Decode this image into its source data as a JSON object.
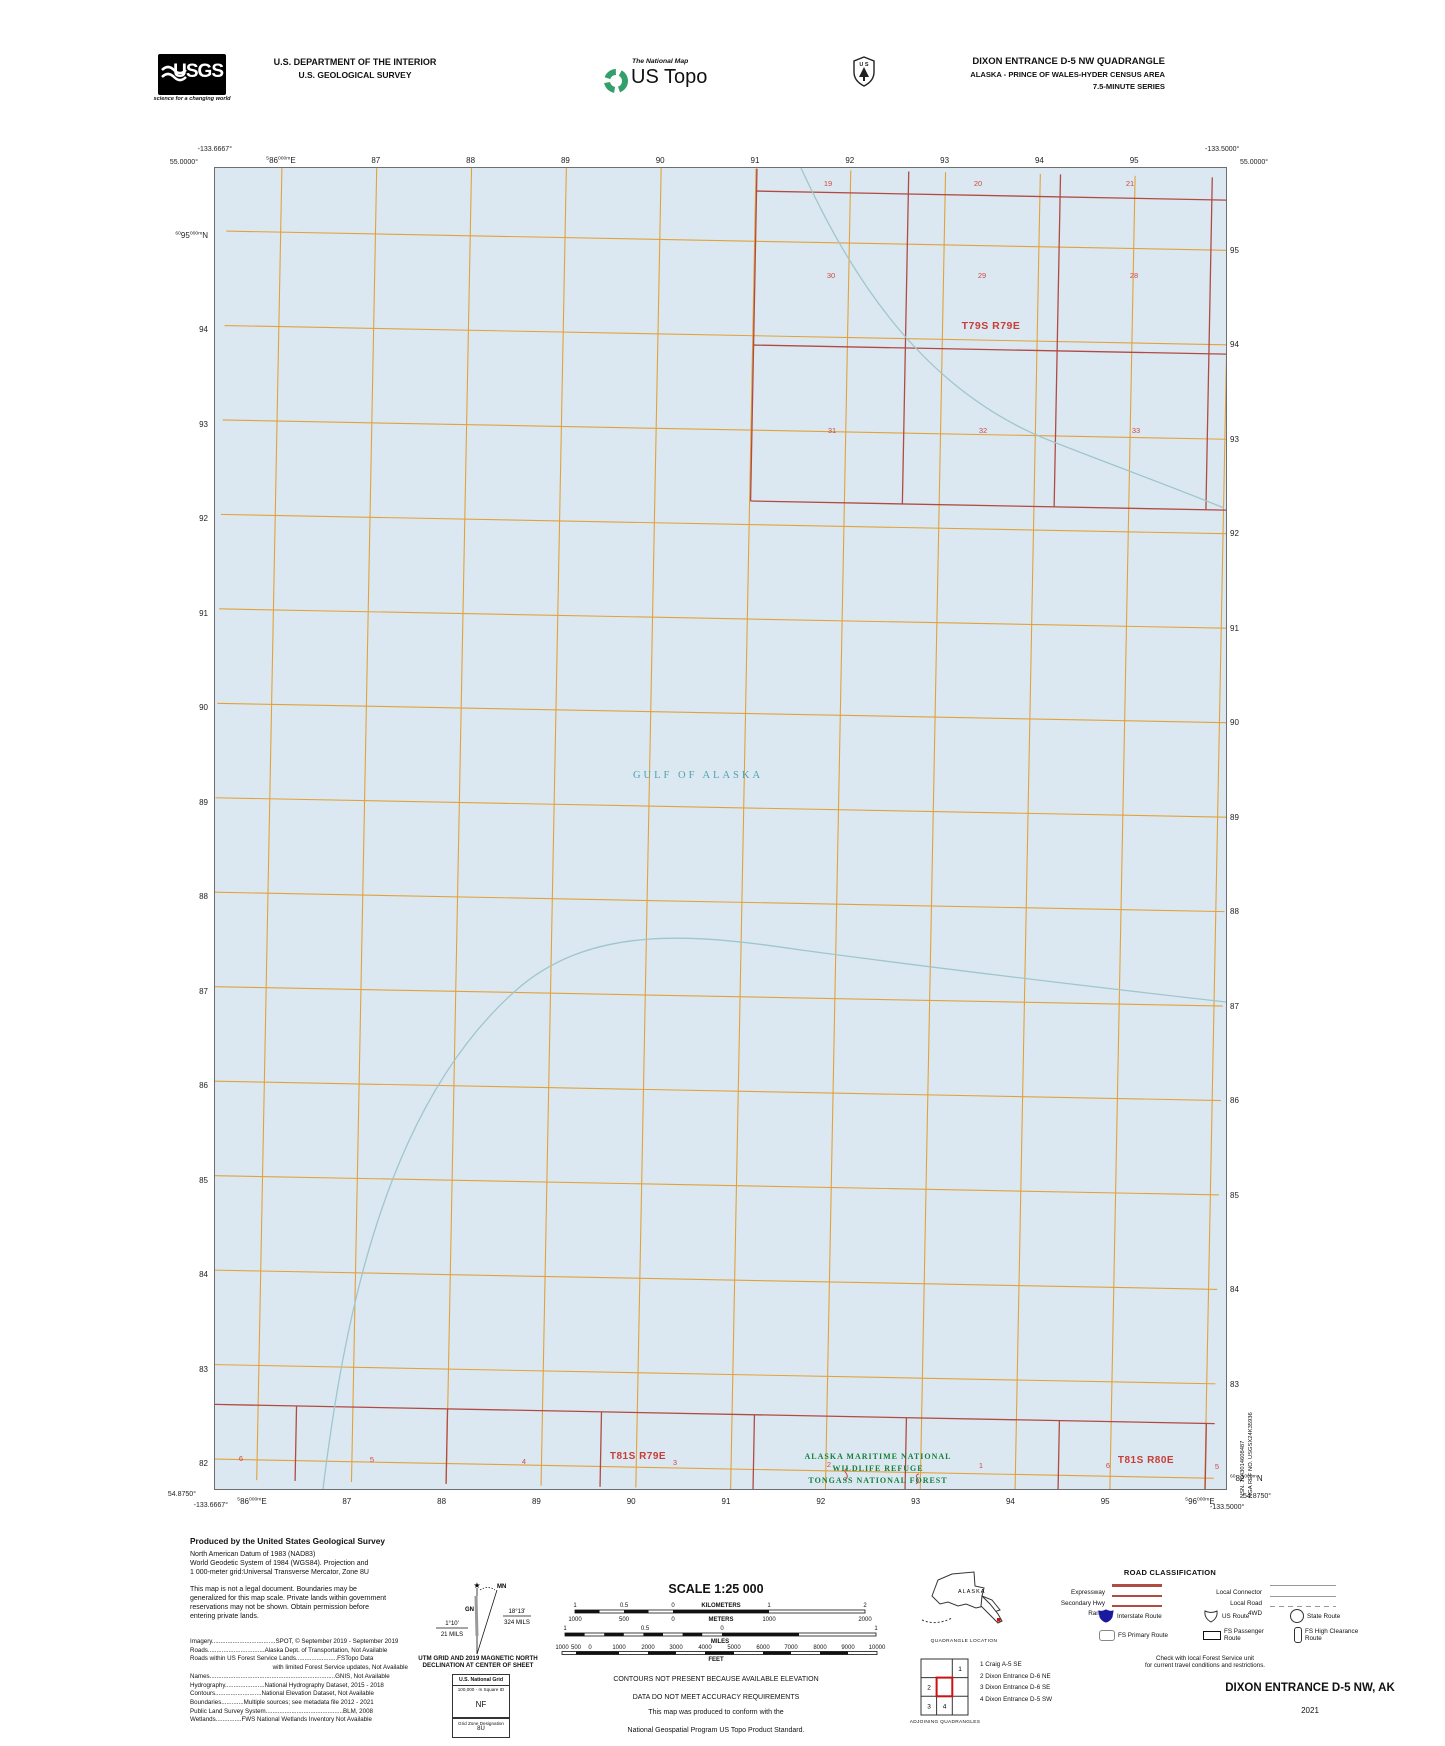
{
  "colors": {
    "water": "#dce8f1",
    "grid_orange": "#e1a23b",
    "plss_red_line": "#b04b44",
    "plss_red_text": "#cc4a44",
    "teal_line": "#9fc6cb",
    "teal_text": "#4ea3b0",
    "green_text": "#15803c",
    "interstate_blue": "#1a1aa0"
  },
  "header": {
    "usgs_text": "USGS",
    "usgs_tagline": "science for a changing world",
    "dept_line1": "U.S. DEPARTMENT OF THE INTERIOR",
    "dept_line2": "U.S. GEOLOGICAL SURVEY",
    "national_map": "The National Map",
    "us_topo": "US Topo",
    "quad_title": "DIXON ENTRANCE D-5 NW QUADRANGLE",
    "quad_subtitle": "ALASKA - PRINCE OF WALES-HYDER CENSUS AREA",
    "quad_series": "7.5-MINUTE SERIES"
  },
  "map": {
    "corner_coords": {
      "top_left_lon": "-133.6667°",
      "top_left_lat": "55.0000°",
      "top_right_lon": "-133.5000°",
      "top_right_lat": "55.0000°",
      "bottom_left_lat": "54.8750°",
      "bottom_left_lon": "-133.6667°",
      "bottom_right_lat": "54.8750°",
      "bottom_right_lon": "-133.5000°"
    },
    "grid": {
      "easting_prefix": "5",
      "northing_prefix": "60",
      "small_suffix": "000m",
      "easting_unit": "E",
      "northing_unit": "N",
      "eastings": [
        "86",
        "87",
        "88",
        "89",
        "90",
        "91",
        "92",
        "93",
        "94",
        "95",
        "96"
      ],
      "northings": [
        "95",
        "94",
        "93",
        "92",
        "91",
        "90",
        "89",
        "88",
        "87",
        "86",
        "85",
        "84",
        "83",
        "82"
      ]
    },
    "water_label": "GULF OF ALASKA",
    "township_t79": {
      "label": "T79S R79E",
      "section_rows": [
        [
          "19",
          "20",
          "21"
        ],
        [
          "30",
          "29",
          "28"
        ],
        [
          "31",
          "32",
          "33"
        ]
      ]
    },
    "bottom_strip": {
      "label_left": "T81S R79E",
      "label_right": "T81S R80E",
      "sections": [
        "6",
        "5",
        "4",
        "3",
        "2",
        "1",
        "6",
        "5"
      ]
    },
    "refuge_lines": [
      "ALASKA MARITIME NATIONAL",
      "WILDLIFE REFUGE",
      "TONGASS NATIONAL FOREST"
    ]
  },
  "produced": {
    "title": "Produced by the United States Geological Survey",
    "datum_lines": [
      "North American Datum of 1983 (NAD83)",
      "World Geodetic System of 1984 (WGS84).  Projection and",
      "1 000-meter grid:Universal Transverse Mercator, Zone 8U"
    ],
    "legal_lines": [
      "This map is not a legal document. Boundaries may be",
      "generalized for this map scale. Private lands within government",
      "reservations may not be shown. Obtain permission before",
      "entering private lands."
    ],
    "credits": [
      "Imagery.....................................SPOT, © September 2019 - September 2019",
      "Roads.................................Alaska Dept. of Transportation, Not Available",
      "Roads  within  US  Forest  Service  Lands........................FSTopo  Data",
      "with limited Forest Service updates, Not Available",
      "Names.........................................................................GNIS, Not Available",
      "Hydrography.......................National Hydrography Dataset, 2015 - 2018",
      "Contours...........................National Elevation Dataset, Not Available",
      "Boundaries.............Multiple sources; see metadata file 2012 - 2021",
      "Public Land Survey System.............................................BLM, 2008",
      "Wetlands...............FWS National Wetlands Inventory Not Available"
    ]
  },
  "declination": {
    "gn_label": "GN",
    "mn_label": "MN",
    "utm_angle": "1°10'",
    "utm_mils": "21 MILS",
    "mn_angle": "18°13'",
    "mn_mils": "324 MILS",
    "caption_lines": [
      "UTM GRID AND 2019 MAGNETIC NORTH",
      "DECLINATION AT CENTER OF SHEET"
    ]
  },
  "usng": {
    "title": "U.S. National Grid",
    "subtitle": "100,000 - m Square ID",
    "square_id": "NF",
    "zone_label": "Grid Zone Designation",
    "zone": "8U"
  },
  "scale_bar": {
    "title": "SCALE 1:25 000",
    "km_labels": [
      "1",
      "0.5",
      "0",
      "1",
      "2"
    ],
    "km_unit": "KILOMETERS",
    "m_labels": [
      "1000",
      "500",
      "0",
      "1000",
      "2000"
    ],
    "m_unit": "METERS",
    "mi_labels": [
      "1",
      "0.5",
      "0",
      "1"
    ],
    "mi_unit": "MILES",
    "ft_labels": [
      "1000",
      "500",
      "0",
      "1000",
      "2000",
      "3000",
      "4000",
      "5000",
      "6000",
      "7000",
      "8000",
      "9000",
      "10000"
    ],
    "ft_unit": "FEET"
  },
  "notes": {
    "contour_lines": [
      "CONTOURS NOT PRESENT BECAUSE AVAILABLE ELEVATION",
      "DATA DO NOT MEET ACCURACY REQUIREMENTS"
    ],
    "standard_lines": [
      "This map was produced to conform with the",
      "National Geospatial Program US Topo Product Standard."
    ]
  },
  "road_class": {
    "title": "ROAD CLASSIFICATION",
    "rows": [
      {
        "left": "Expressway",
        "right": "Local Connector"
      },
      {
        "left": "Secondary Hwy",
        "right": "Local Road"
      },
      {
        "left": "Ramp",
        "right": "4WD"
      }
    ],
    "interstate_label": "Interstate Route",
    "us_route_label": "US Route",
    "state_route_label": "State Route",
    "fs_primary_label": "FS Primary Route",
    "fs_passenger_label": "FS Passenger Route",
    "fs_high_label": "FS High Clearance Route",
    "note_lines": [
      "Check with local Forest Service unit",
      "for current travel conditions and restrictions."
    ]
  },
  "location_map": {
    "state_label": "ALASKA",
    "caption": "QUADRANGLE LOCATION"
  },
  "adjoining": {
    "caption": "ADJOINING QUADRANGLES",
    "cell_numbers": [
      "1",
      "2",
      "3",
      "4"
    ],
    "list": [
      "1 Craig A-5 SE",
      "2 Dixon Entrance D-6 NE",
      "3 Dixon Entrance D-6 SE",
      "4 Dixon Entrance D-5 SW"
    ]
  },
  "title_block": {
    "title": "DIXON ENTRANCE D-5 NW,  AK",
    "year": "2021"
  },
  "edge_text": {
    "nsn": "NSN. 7643014608487",
    "nga": "NGA REF NO. USGSX24K35936"
  }
}
